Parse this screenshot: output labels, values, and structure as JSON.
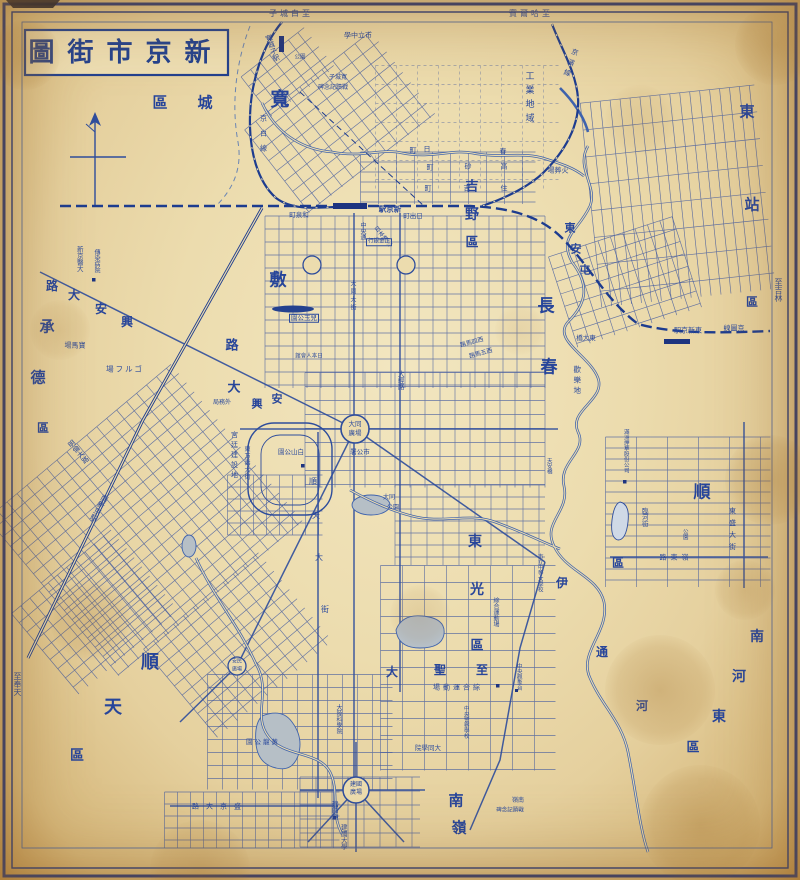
{
  "title": {
    "text": "圖街市京新"
  },
  "colors": {
    "ink": "#2b4a9d",
    "ink_dark": "#1d3480",
    "paper": "#ecdcae",
    "pond_gray": "#b6bfc6",
    "pond_blue": "#cfd9e6"
  },
  "margin_notes": [
    {
      "t": "子城白至",
      "x": 291,
      "y": 14,
      "s": 8,
      "ls": 3
    },
    {
      "t": "賓爾哈至",
      "x": 531,
      "y": 14,
      "s": 8,
      "ls": 3
    },
    {
      "t": "至吉林",
      "x": 778,
      "y": 290,
      "s": 8,
      "o": "v"
    },
    {
      "t": "至奉天",
      "x": 17,
      "y": 684,
      "s": 8,
      "o": "v"
    }
  ],
  "labels": [
    {
      "t": "寬",
      "x": 280,
      "y": 100,
      "s": 19,
      "cls": "big"
    },
    {
      "t": "城",
      "x": 205,
      "y": 103,
      "s": 15,
      "cls": "big"
    },
    {
      "t": "區",
      "x": 160,
      "y": 103,
      "s": 15,
      "cls": "big"
    },
    {
      "t": "吉",
      "x": 472,
      "y": 187,
      "s": 13,
      "cls": "big"
    },
    {
      "t": "野",
      "x": 472,
      "y": 215,
      "s": 14,
      "cls": "big"
    },
    {
      "t": "區",
      "x": 472,
      "y": 243,
      "s": 13,
      "cls": "big"
    },
    {
      "t": "敷",
      "x": 278,
      "y": 281,
      "s": 17,
      "cls": "big"
    },
    {
      "t": "長",
      "x": 546,
      "y": 307,
      "s": 17,
      "cls": "big"
    },
    {
      "t": "春",
      "x": 549,
      "y": 368,
      "s": 17,
      "cls": "big"
    },
    {
      "t": "東",
      "x": 747,
      "y": 112,
      "s": 15,
      "cls": "big"
    },
    {
      "t": "站",
      "x": 752,
      "y": 205,
      "s": 15,
      "cls": "big"
    },
    {
      "t": "區",
      "x": 752,
      "y": 302,
      "s": 12,
      "cls": "big"
    },
    {
      "t": "東",
      "x": 570,
      "y": 228,
      "s": 11,
      "cls": "big"
    },
    {
      "t": "安",
      "x": 576,
      "y": 249,
      "s": 11,
      "cls": "big"
    },
    {
      "t": "屯",
      "x": 585,
      "y": 270,
      "s": 11,
      "cls": "big"
    },
    {
      "t": "順",
      "x": 702,
      "y": 493,
      "s": 17,
      "cls": "big"
    },
    {
      "t": "區",
      "x": 618,
      "y": 563,
      "s": 12,
      "cls": "big"
    },
    {
      "t": "東",
      "x": 475,
      "y": 542,
      "s": 14,
      "cls": "big"
    },
    {
      "t": "光",
      "x": 477,
      "y": 590,
      "s": 14,
      "cls": "big"
    },
    {
      "t": "區",
      "x": 477,
      "y": 646,
      "s": 13,
      "cls": "big"
    },
    {
      "t": "南",
      "x": 757,
      "y": 637,
      "s": 14,
      "cls": "big"
    },
    {
      "t": "河",
      "x": 739,
      "y": 677,
      "s": 14,
      "cls": "big"
    },
    {
      "t": "東",
      "x": 719,
      "y": 717,
      "s": 14,
      "cls": "big"
    },
    {
      "t": "區",
      "x": 693,
      "y": 748,
      "s": 13,
      "cls": "big"
    },
    {
      "t": "順",
      "x": 150,
      "y": 663,
      "s": 18,
      "cls": "big"
    },
    {
      "t": "天",
      "x": 113,
      "y": 708,
      "s": 18,
      "cls": "big"
    },
    {
      "t": "區",
      "x": 77,
      "y": 756,
      "s": 14,
      "cls": "big"
    },
    {
      "t": "承",
      "x": 47,
      "y": 327,
      "s": 15,
      "cls": "big"
    },
    {
      "t": "德",
      "x": 38,
      "y": 378,
      "s": 15,
      "cls": "big"
    },
    {
      "t": "區",
      "x": 43,
      "y": 428,
      "s": 12,
      "cls": "big"
    },
    {
      "t": "南",
      "x": 456,
      "y": 801,
      "s": 15,
      "cls": "big"
    },
    {
      "t": "嶺",
      "x": 459,
      "y": 828,
      "s": 15,
      "cls": "big"
    },
    {
      "t": "伊",
      "x": 562,
      "y": 583,
      "s": 12,
      "cls": "big"
    },
    {
      "t": "通",
      "x": 602,
      "y": 652,
      "s": 12,
      "cls": "big"
    },
    {
      "t": "河",
      "x": 642,
      "y": 706,
      "s": 12,
      "cls": "big"
    },
    {
      "t": "路",
      "x": 52,
      "y": 286,
      "s": 12,
      "cls": "big"
    },
    {
      "t": "大",
      "x": 74,
      "y": 295,
      "s": 12,
      "cls": "big"
    },
    {
      "t": "安",
      "x": 101,
      "y": 309,
      "s": 12,
      "cls": "big"
    },
    {
      "t": "興",
      "x": 127,
      "y": 322,
      "s": 12,
      "cls": "big"
    },
    {
      "t": "路",
      "x": 232,
      "y": 346,
      "s": 13,
      "cls": "big"
    },
    {
      "t": "大",
      "x": 234,
      "y": 388,
      "s": 13,
      "cls": "big"
    },
    {
      "t": "興",
      "x": 257,
      "y": 404,
      "s": 11,
      "cls": "big"
    },
    {
      "t": "安",
      "x": 277,
      "y": 399,
      "s": 11,
      "cls": "big"
    },
    {
      "t": "至",
      "x": 482,
      "y": 670,
      "s": 12,
      "cls": "big"
    },
    {
      "t": "聖",
      "x": 440,
      "y": 670,
      "s": 12,
      "cls": "big"
    },
    {
      "t": "大",
      "x": 392,
      "y": 672,
      "s": 12,
      "cls": "big"
    },
    {
      "t": "寬城子駅",
      "x": 272,
      "y": 48,
      "s": 7,
      "o": "v",
      "r": -20
    },
    {
      "t": "學中立市",
      "x": 358,
      "y": 36,
      "s": 7
    },
    {
      "t": "公園",
      "x": 300,
      "y": 58,
      "s": 5.5
    },
    {
      "t": "子城寬",
      "x": 338,
      "y": 78,
      "s": 6
    },
    {
      "t": "碑念記蹟戰",
      "x": 333,
      "y": 88,
      "s": 6
    },
    {
      "t": "工業地域",
      "x": 528,
      "y": 99,
      "s": 9,
      "o": "v",
      "ls": 5
    },
    {
      "t": "京白線",
      "x": 263,
      "y": 137,
      "s": 7,
      "o": "v",
      "ls": 8
    },
    {
      "t": "京濱線",
      "x": 570,
      "y": 64,
      "s": 7,
      "o": "v",
      "ls": 4,
      "r": 20
    },
    {
      "t": "場葬火",
      "x": 558,
      "y": 171,
      "s": 7
    },
    {
      "t": "町",
      "x": 413,
      "y": 151,
      "s": 7
    },
    {
      "t": "日",
      "x": 427,
      "y": 150,
      "s": 7
    },
    {
      "t": "春",
      "x": 503,
      "y": 152,
      "s": 7
    },
    {
      "t": "町",
      "x": 430,
      "y": 168,
      "s": 7
    },
    {
      "t": "砂",
      "x": 468,
      "y": 167,
      "s": 7
    },
    {
      "t": "高",
      "x": 504,
      "y": 167,
      "s": 7
    },
    {
      "t": "町",
      "x": 428,
      "y": 189,
      "s": 7
    },
    {
      "t": "吉",
      "x": 467,
      "y": 189,
      "s": 7
    },
    {
      "t": "住",
      "x": 504,
      "y": 189,
      "s": 7
    },
    {
      "t": "駅京新",
      "x": 390,
      "y": 209,
      "s": 7.5,
      "cls": "st"
    },
    {
      "t": "町出日",
      "x": 413,
      "y": 216,
      "s": 6.5
    },
    {
      "t": "町泉和",
      "x": 299,
      "y": 215,
      "s": 6.5
    },
    {
      "t": "中央通",
      "x": 362,
      "y": 231,
      "s": 6,
      "o": "v"
    },
    {
      "t": "日本橋通",
      "x": 382,
      "y": 237,
      "s": 6,
      "o": "v",
      "r": -38
    },
    {
      "t": "行銀金正",
      "x": 379,
      "y": 242,
      "s": 5.5,
      "bx": true
    },
    {
      "t": "大同大街",
      "x": 352,
      "y": 296,
      "s": 6,
      "o": "v",
      "ls": 2
    },
    {
      "t": "園公玉兒",
      "x": 304,
      "y": 318,
      "s": 6.5,
      "bx": true
    },
    {
      "t": "館會人本日",
      "x": 309,
      "y": 357,
      "s": 5.5
    },
    {
      "t": "路馬四西",
      "x": 472,
      "y": 343,
      "s": 6,
      "r": -15
    },
    {
      "t": "路馬五西",
      "x": 481,
      "y": 354,
      "s": 6,
      "r": -15
    },
    {
      "t": "大經路",
      "x": 400,
      "y": 380,
      "s": 6.5,
      "o": "v"
    },
    {
      "t": "局務外",
      "x": 222,
      "y": 403,
      "s": 6
    },
    {
      "t": "大同",
      "x": 355,
      "y": 424,
      "s": 6.5
    },
    {
      "t": "廣場",
      "x": 355,
      "y": 433,
      "s": 6.5
    },
    {
      "t": "署公市",
      "x": 360,
      "y": 452,
      "s": 6.5
    },
    {
      "t": "園公山白",
      "x": 291,
      "y": 452,
      "s": 6.5
    },
    {
      "t": "宮廷建設地",
      "x": 234,
      "y": 456,
      "s": 7,
      "o": "v",
      "ls": 3
    },
    {
      "t": "東万壽大街",
      "x": 246,
      "y": 463,
      "s": 6,
      "o": "v",
      "ls": 1
    },
    {
      "t": "大同",
      "x": 389,
      "y": 498,
      "s": 6
    },
    {
      "t": "公園",
      "x": 393,
      "y": 508,
      "s": 6
    },
    {
      "t": "新京醫大",
      "x": 79,
      "y": 259,
      "s": 6.5,
      "o": "v"
    },
    {
      "t": "傳染病院",
      "x": 96,
      "y": 261,
      "s": 6,
      "o": "v"
    },
    {
      "t": "場馬寶",
      "x": 75,
      "y": 346,
      "s": 7
    },
    {
      "t": "場フルゴ",
      "x": 125,
      "y": 369,
      "s": 7.5,
      "ls": 2
    },
    {
      "t": "明倫大路",
      "x": 78,
      "y": 452,
      "s": 7,
      "o": "v",
      "r": -40
    },
    {
      "t": "南新京駅",
      "x": 99,
      "y": 508,
      "s": 7.5,
      "o": "v",
      "r": 28
    },
    {
      "t": "駅京新東",
      "x": 688,
      "y": 331,
      "s": 7
    },
    {
      "t": "線圖京",
      "x": 734,
      "y": 329,
      "s": 7
    },
    {
      "t": "橋大東",
      "x": 586,
      "y": 338,
      "s": 6.5
    },
    {
      "t": "歡樂地",
      "x": 577,
      "y": 381,
      "s": 7.5,
      "o": "v",
      "ls": 3
    },
    {
      "t": "滿洲煙草股份公司",
      "x": 625,
      "y": 451,
      "s": 5.5,
      "o": "v"
    },
    {
      "t": "臨河街",
      "x": 644,
      "y": 517,
      "s": 6.5,
      "o": "v"
    },
    {
      "t": "公園",
      "x": 684,
      "y": 534,
      "s": 5.5,
      "o": "v"
    },
    {
      "t": "東盛大街",
      "x": 732,
      "y": 531,
      "s": 7,
      "o": "v",
      "ls": 5
    },
    {
      "t": "路東嶺",
      "x": 676,
      "y": 558,
      "s": 7,
      "ls": 4
    },
    {
      "t": "天安橋",
      "x": 548,
      "y": 466,
      "s": 5.5,
      "o": "v"
    },
    {
      "t": "市立中等女學校",
      "x": 539,
      "y": 573,
      "s": 5.5,
      "o": "v"
    },
    {
      "t": "綜合運動場",
      "x": 495,
      "y": 612,
      "s": 6,
      "o": "v"
    },
    {
      "t": "場動運合綜",
      "x": 458,
      "y": 688,
      "s": 7,
      "ls": 3
    },
    {
      "t": "中央觀象台",
      "x": 518,
      "y": 677,
      "s": 5.5,
      "o": "v"
    },
    {
      "t": "中央警察學校",
      "x": 465,
      "y": 722,
      "s": 5.5,
      "o": "v"
    },
    {
      "t": "院學同大",
      "x": 428,
      "y": 748,
      "s": 6.5
    },
    {
      "t": "大陸科學院",
      "x": 338,
      "y": 719,
      "s": 6,
      "o": "v"
    },
    {
      "t": "順",
      "x": 313,
      "y": 482,
      "s": 8
    },
    {
      "t": "天",
      "x": 316,
      "y": 516,
      "s": 8
    },
    {
      "t": "大",
      "x": 319,
      "y": 558,
      "s": 8
    },
    {
      "t": "街",
      "x": 325,
      "y": 610,
      "s": 8
    },
    {
      "t": "安民",
      "x": 237,
      "y": 662,
      "s": 5
    },
    {
      "t": "廣場",
      "x": 237,
      "y": 670,
      "s": 5
    },
    {
      "t": "建國",
      "x": 356,
      "y": 785,
      "s": 6
    },
    {
      "t": "廣場",
      "x": 356,
      "y": 793,
      "s": 6
    },
    {
      "t": "建國廟",
      "x": 334,
      "y": 810,
      "s": 6.5,
      "o": "v"
    },
    {
      "t": "建國大學",
      "x": 343,
      "y": 837,
      "s": 6.5,
      "o": "v"
    },
    {
      "t": "園公龍黃",
      "x": 263,
      "y": 742,
      "s": 6.5,
      "ls": 2
    },
    {
      "t": "路大京盛",
      "x": 220,
      "y": 807,
      "s": 7,
      "ls": 7
    },
    {
      "t": "嶺南",
      "x": 518,
      "y": 801,
      "s": 6
    },
    {
      "t": "碑念記蹟戰",
      "x": 510,
      "y": 811,
      "s": 5.5
    }
  ]
}
